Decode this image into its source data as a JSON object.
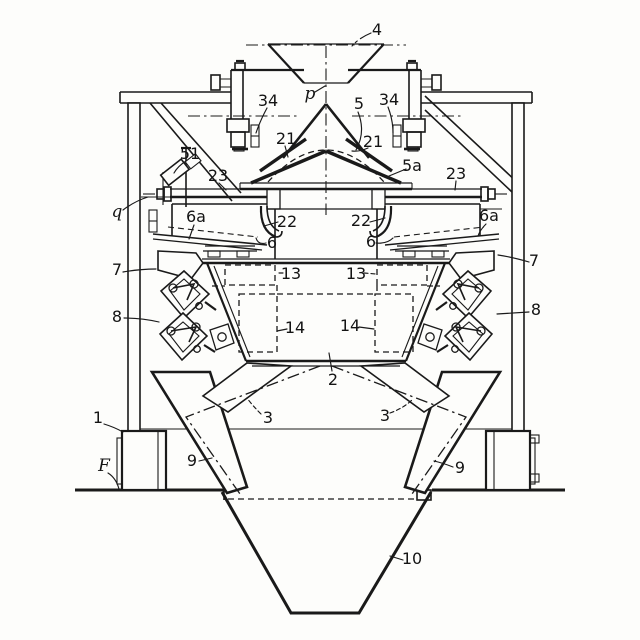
{
  "figure": {
    "background": "#fdfdfb",
    "ink": "#1a1a1a",
    "labels": {
      "n1": "1",
      "n2": "2",
      "n3_left": "3",
      "n3_right": "3",
      "n4": "4",
      "n5": "5",
      "n5a": "5a",
      "n6_left": "6",
      "n6_right": "6",
      "n6a_left": "6a",
      "n6a_right": "6a",
      "n7_left": "7",
      "n7_right": "7",
      "n8_left": "8",
      "n8_right": "8",
      "n9_left": "9",
      "n9_right": "9",
      "n10": "10",
      "n13_left": "13",
      "n13_right": "13",
      "n14_left": "14",
      "n14_right": "14",
      "n21_left": "21",
      "n21_right": "21",
      "n22_left": "22",
      "n22_right": "22",
      "n23_left": "23",
      "n23_right": "23",
      "n34_left": "34",
      "n34_right": "34",
      "n51": "51",
      "p": "p",
      "q": "q",
      "F": "F"
    }
  }
}
